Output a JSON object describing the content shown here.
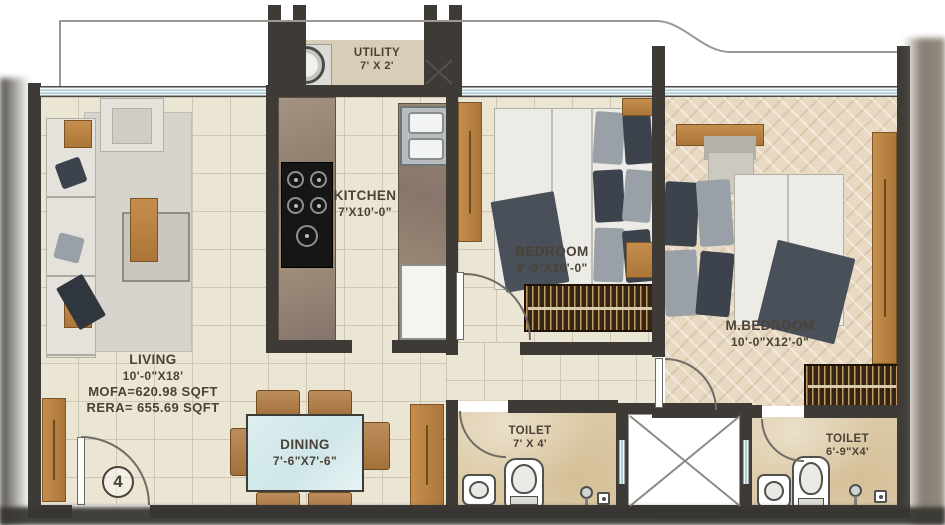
{
  "plan_type": "apartment-floor-plan",
  "unit": {
    "number": "4"
  },
  "rooms": {
    "utility": {
      "label": "UTILITY",
      "dims": "7' X 2'"
    },
    "kitchen": {
      "label": "KITCHEN",
      "dims": "7'X10'-0\""
    },
    "bedroom": {
      "label": "BEDROOM",
      "dims": "9'-0\"X10'-0\""
    },
    "master_bedroom": {
      "label": "M.BEDROOM",
      "dims": "10'-0\"X12'-0\""
    },
    "living": {
      "label": "LIVING",
      "dims": "10'-0\"X18'",
      "mofa": "MOFA=620.98 SQFT",
      "rera": "RERA= 655.69 SQFT"
    },
    "dining": {
      "label": "DINING",
      "dims": "7'-6\"X7'-6\""
    },
    "toilet_1": {
      "label": "TOILET",
      "dims": "7' X 4'"
    },
    "toilet_2": {
      "label": "TOILET",
      "dims": "6'-9\"X4'"
    }
  },
  "colors": {
    "wall": "#3e3b37",
    "floor_tile": "#ebe5d4",
    "floor_herringbone": "#e8d9c2",
    "floor_marble": "#dccaa6",
    "window_glass": "#a9cdd4",
    "wood": "#c68e4e",
    "dining_glass": "#cfe6e8",
    "label_text": "#4b4237"
  }
}
